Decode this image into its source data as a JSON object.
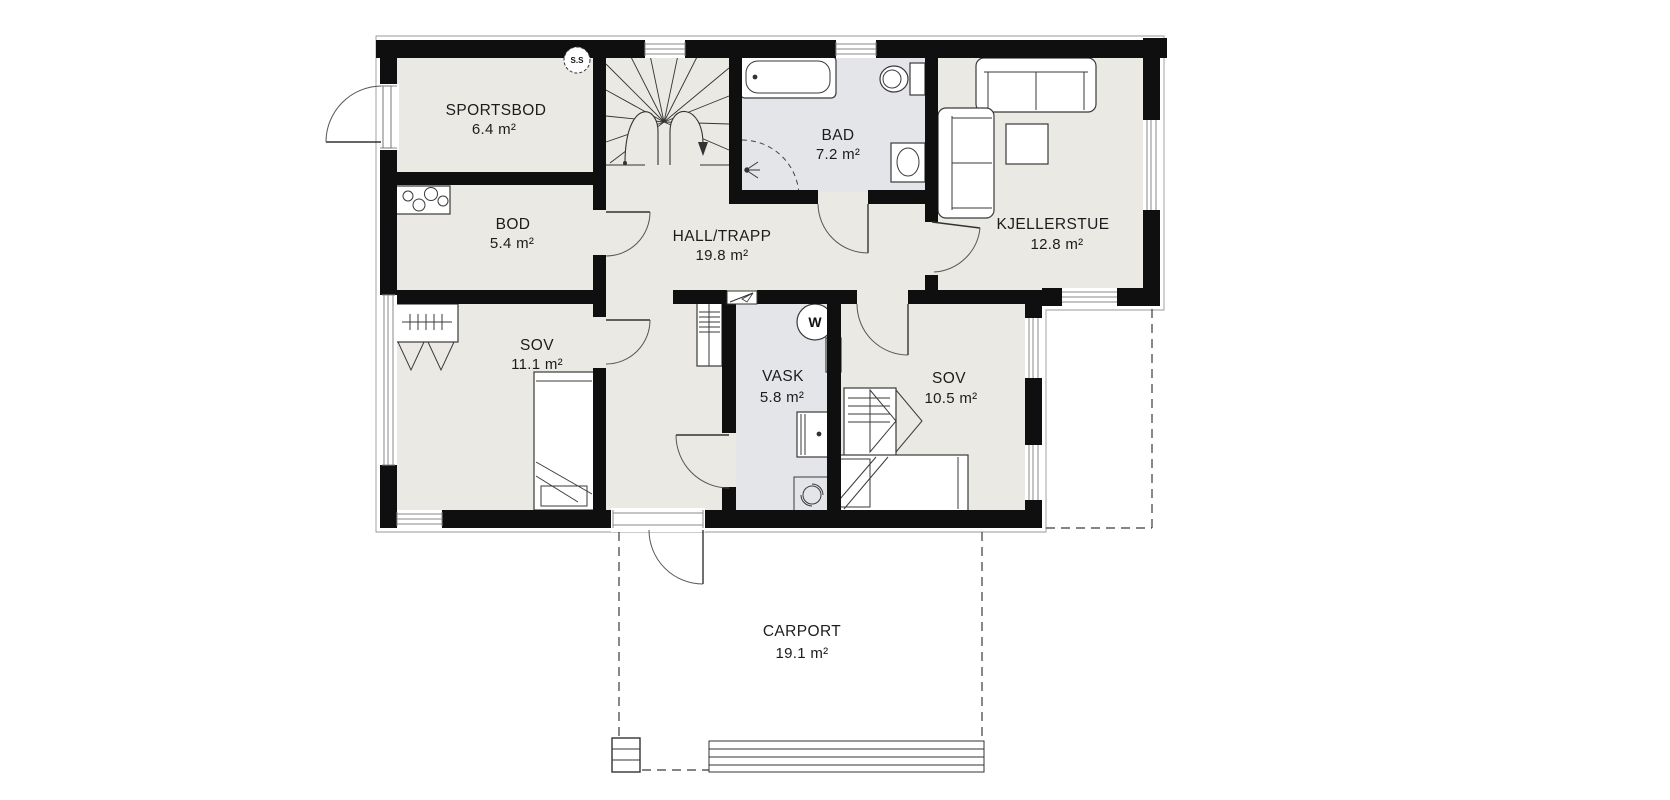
{
  "plan": {
    "title": "Basement floor plan",
    "rooms": {
      "sportsbod": {
        "name": "SPORTSBOD",
        "area": "6.4 m²"
      },
      "bod": {
        "name": "BOD",
        "area": "5.4 m²"
      },
      "hall": {
        "name": "HALL/TRAPP",
        "area": "19.8 m²"
      },
      "bad": {
        "name": "BAD",
        "area": "7.2 m²"
      },
      "kjellerstue": {
        "name": "KJELLERSTUE",
        "area": "12.8 m²"
      },
      "sov1": {
        "name": "SOV",
        "area": "11.1 m²"
      },
      "vask": {
        "name": "VASK",
        "area": "5.8 m²"
      },
      "sov2": {
        "name": "SOV",
        "area": "10.5 m²"
      },
      "carport": {
        "name": "CARPORT",
        "area": "19.1 m²"
      }
    },
    "symbols": {
      "fuse_box_label": "S.S",
      "water_heater_label": "W"
    },
    "colors": {
      "wall": "#0f0f0f",
      "floor": "#ebe9e3",
      "wet_room_floor": "#e3e5e8",
      "background": "#ffffff"
    }
  }
}
